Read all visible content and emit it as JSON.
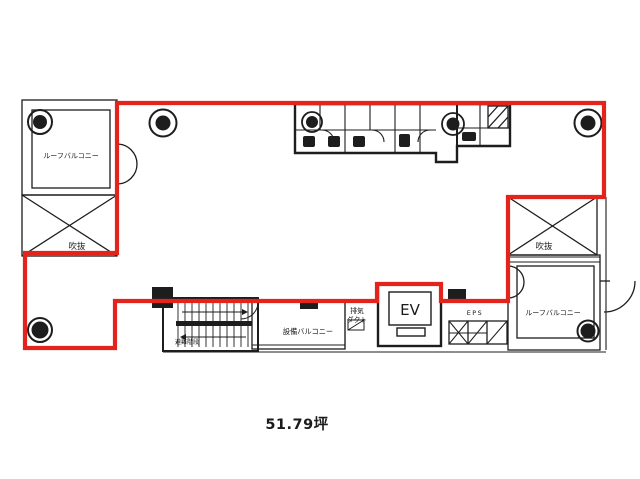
{
  "floor_plan": {
    "area_label": "51.79坪",
    "rooms": {
      "roof_balcony_left": "ルーフバルコニー",
      "roof_balcony_right": "ルーフバルコニー",
      "void_left": "吹抜",
      "void_right": "吹抜",
      "elevator": "EV",
      "eps": "EPS",
      "exhaust_duct_line1": "排気",
      "exhaust_duct_line2": "ダクト",
      "equipment_balcony": "設備バルコニー",
      "escape_stairs": "避難階段"
    },
    "colors": {
      "lease_outline": "#e3241c",
      "drawing_lines": "#1d1d1d",
      "area_text": "#262626"
    },
    "icons": {
      "vent_fan": "concentric-circles-vent",
      "void_cross": "x-diagonal-cross",
      "hatch_panel": "diagonal-hatch"
    }
  }
}
